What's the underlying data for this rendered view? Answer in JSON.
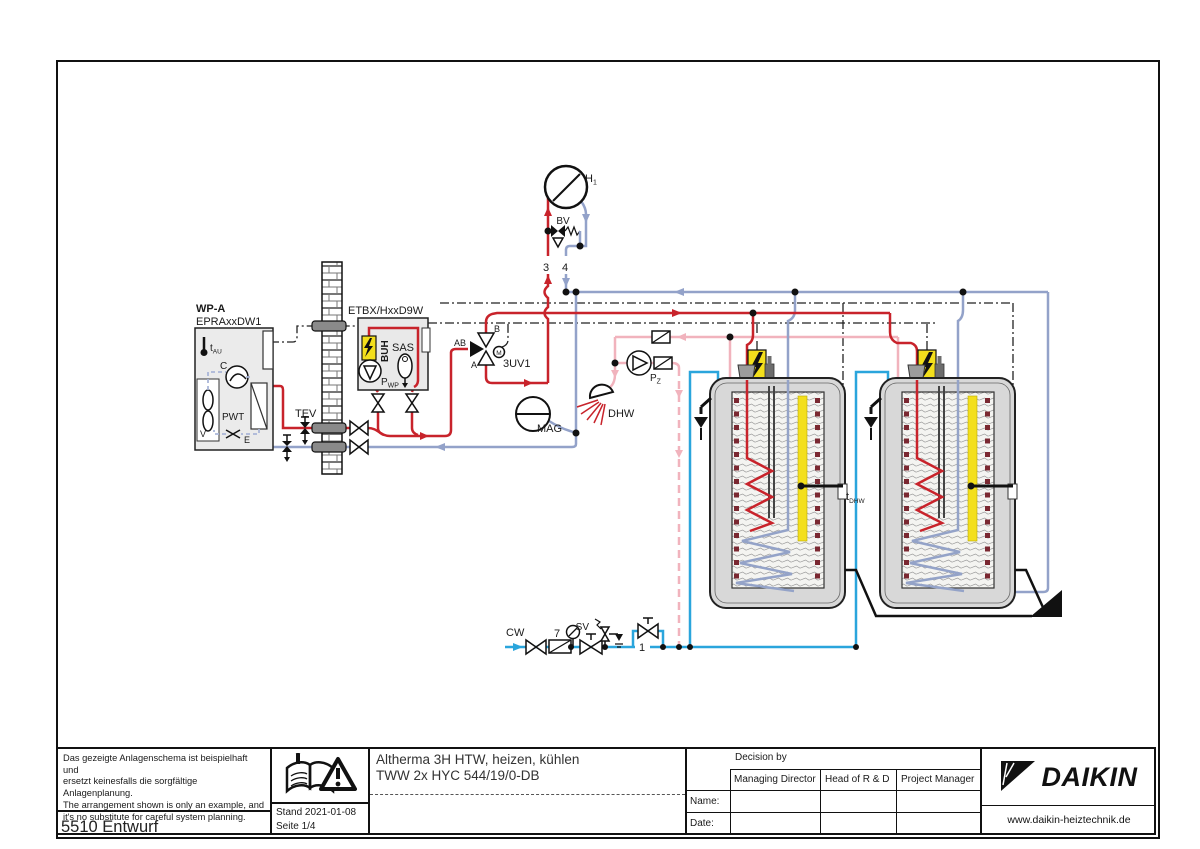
{
  "sch": {
    "wp_name": "WP-A",
    "wp_model": "EPRAxxDW1",
    "t_main": "t",
    "t_sub": "AU",
    "compressor": "C",
    "fan": "V",
    "pwt": "PWT",
    "evap": "E",
    "tev": "TEV",
    "etbx": "ETBX/HxxD9W",
    "buh": "BUH",
    "sas": "SAS",
    "pwp_main": "P",
    "pwp_sub": "WP",
    "valve3uv": "3UV1",
    "port_ab": "AB",
    "port_a": "A",
    "port_b": "B",
    "actuator_m": "M",
    "h_main": "H",
    "h_sub": "1",
    "bv": "BV",
    "pipe3": "3",
    "pipe4": "4",
    "mag": "MAG",
    "dhw": "DHW",
    "pz_main": "P",
    "pz_sub": "Z",
    "cw": "CW",
    "pipe7": "7",
    "sv": "SV",
    "pipe1": "1",
    "tdhw_main": "t",
    "tdhw_sub": "DHW"
  },
  "colors": {
    "flow_red": "#c8232b",
    "return_blue": "#93a2c9",
    "cold_water": "#2aa5dc",
    "dhw_pink": "#f1b3bd",
    "heater_yellow": "#f3df1c"
  },
  "tb": {
    "disclaimer": [
      "Das gezeigte Anlagenschema ist beispielhaft und",
      "ersetzt keinesfalls die sorgfältige Anlagenplanung.",
      "The arrangement shown is only an example, and",
      "it's no substitute for careful system planning."
    ],
    "doc_id": "5510 Entwurf",
    "stand": "Stand 2021-01-08",
    "seite": "Seite 1/4",
    "title1": "Altherma 3H HTW, heizen, kühlen",
    "title2": "TWW 2x HYC 544/19/0-DB",
    "decision": {
      "header": "Decision by",
      "cols": [
        "Managing Director",
        "Head of R & D",
        "Project Manager"
      ],
      "rows": [
        "Name:",
        "Date:"
      ]
    },
    "brand": "DAIKIN",
    "website": "www.daikin-heiztechnik.de"
  }
}
